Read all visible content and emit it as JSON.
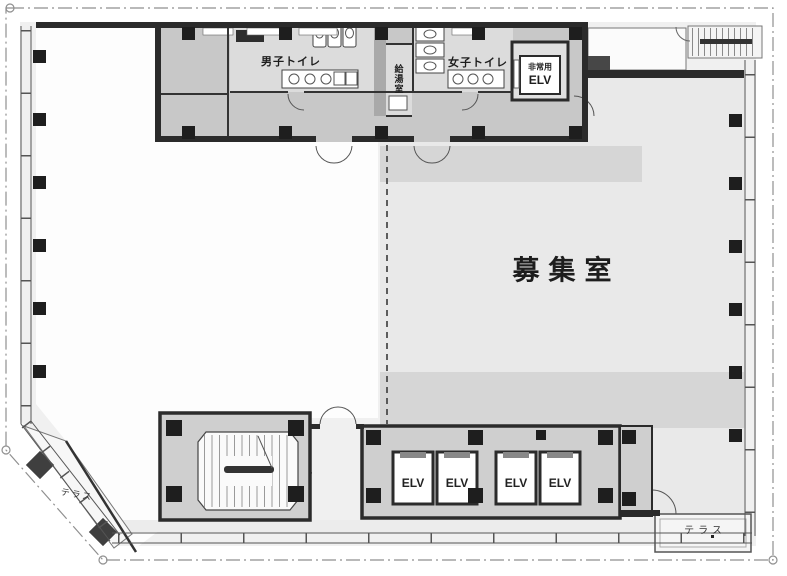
{
  "plan": {
    "type": "office-floor-plan",
    "rooms": {
      "main": {
        "label": "募集室"
      },
      "mens_toilet": {
        "label": "男子トイレ"
      },
      "womens_toilet": {
        "label": "女子トイレ"
      },
      "kitchenette": {
        "label": "給湯室"
      },
      "emergency_elevator": {
        "label_top": "非常用",
        "label_bottom": "ELV"
      },
      "terrace_left": {
        "label": "テラス"
      },
      "terrace_right": {
        "label": "テラス"
      }
    },
    "elevators": [
      {
        "label": "ELV"
      },
      {
        "label": "ELV"
      },
      {
        "label": "ELV"
      },
      {
        "label": "ELV"
      }
    ],
    "colors": {
      "wall": "#2b2b2b",
      "core_fill": "#c8c8c8",
      "room_fill": "#e9e9e9",
      "band_fill": "#d6d6d6",
      "block_fill": "#cfcfcf",
      "boundary_line": "#8f8f8f",
      "glass_line": "#555555"
    }
  }
}
